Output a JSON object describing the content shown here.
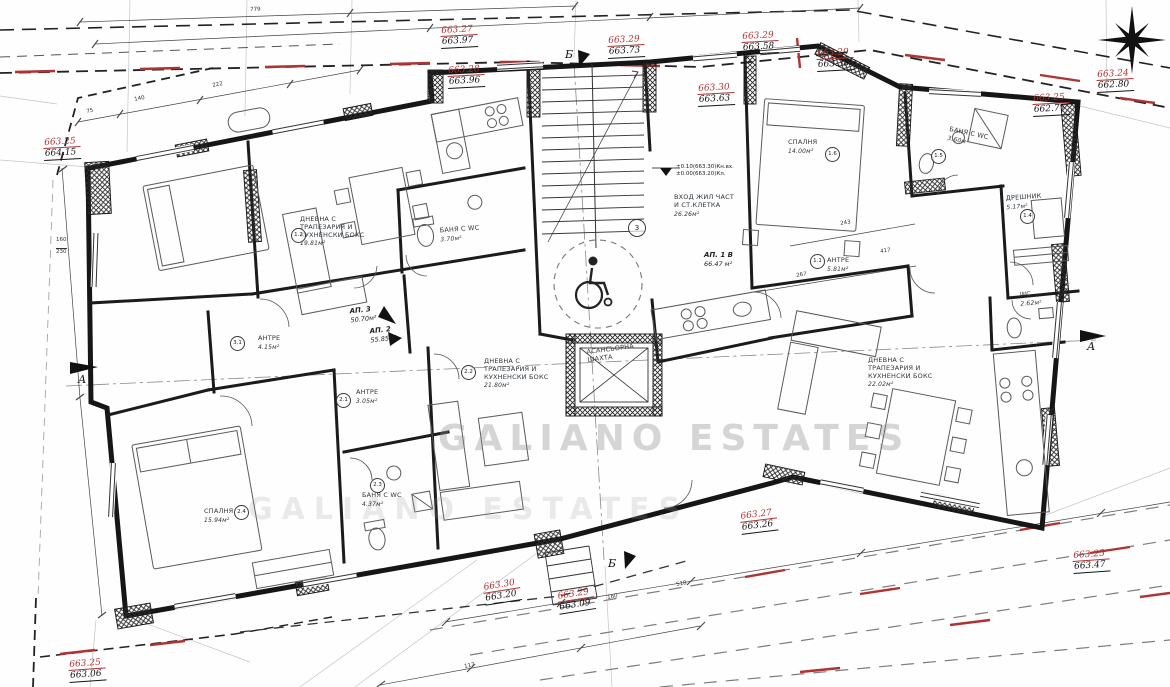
{
  "watermark": {
    "line1": "GALIANO ESTATES",
    "line2": "GALIANO ESTATES"
  },
  "colors": {
    "marker_red": "#b03232",
    "line_black": "#141414",
    "construction_gray": "#9a9a9a"
  },
  "icons": {
    "north": "north-arrow-icon",
    "wheelchair": "wheelchair-icon"
  },
  "axes": {
    "a": "А",
    "b": "Б"
  },
  "levels": {
    "line1": "±0.10(663.30)Кн.вх.",
    "line2": "±0.00(663.20)Кл."
  },
  "apartments": [
    {
      "label": "АП. 1 В",
      "area": "66.47 м²"
    },
    {
      "label": "АП. 2",
      "area": "55.85м²"
    },
    {
      "label": "АП. 3",
      "area": "50.70м²"
    }
  ],
  "rooms": [
    {
      "lines": [
        "ДНЕВНА С",
        "ТРАПЕЗАРИЯ И",
        "КУХНЕНСКИ БОКС"
      ],
      "area": "19.81м²"
    },
    {
      "lines": [
        "БАНЯ С WC"
      ],
      "area": "3.70м²"
    },
    {
      "lines": [
        "СПАЛНЯ"
      ],
      "area": "14.00м²"
    },
    {
      "lines": [
        "БАНЯ С WC"
      ],
      "area": "3.60м²"
    },
    {
      "lines": [
        "ДРЕШНИК"
      ],
      "area": "5.17м²"
    },
    {
      "lines": [
        "АНТРЕ"
      ],
      "area": "5.81м²"
    },
    {
      "lines": [
        "WC"
      ],
      "area": "2.62м²"
    },
    {
      "lines": [
        "ВХОД ЖИЛ ЧАСТ",
        "И СТ.КЛЕТКА"
      ],
      "area": "26.26м²"
    },
    {
      "lines": [
        "АНТРЕ"
      ],
      "area": "4.15м²"
    },
    {
      "lines": [
        "АНТРЕ"
      ],
      "area": "3.05м²"
    },
    {
      "lines": [
        "ДНЕВНА С",
        "ТРАПЕЗАРИЯ И",
        "КУХНЕНСКИ БОКС"
      ],
      "area": "21.80м²"
    },
    {
      "lines": [
        "АСАНСЬОРНА",
        "ШАХТА"
      ],
      "area": ""
    },
    {
      "lines": [
        "СПАЛНЯ"
      ],
      "area": "15.94м²"
    },
    {
      "lines": [
        "БАНЯ С WC"
      ],
      "area": "4.37м²"
    },
    {
      "lines": [
        "ДНЕВНА С",
        "ТРАПЕЗАРИЯ И",
        "КУХНЕНСКИ БОКС"
      ],
      "area": "22.02м²"
    }
  ],
  "circles": [
    "3",
    "1.2",
    "1.6",
    "1.5",
    "1.4",
    "1.1",
    "2.2",
    "2.1",
    "2.3",
    "2.4",
    "3.1"
  ],
  "elevations": [
    {
      "red": "663.27",
      "black": "663.97"
    },
    {
      "red": "663.28",
      "black": "663.96"
    },
    {
      "red": "663.29",
      "black": "663.73"
    },
    {
      "red": "663.29",
      "black": "663.58"
    },
    {
      "red": "663.29",
      "black": "663.38"
    },
    {
      "red": "663.30",
      "black": "663.63"
    },
    {
      "red": "663.24",
      "black": "662.80"
    },
    {
      "red": "663.25",
      "black": "662.77"
    },
    {
      "red": "663.25",
      "black": "664.15"
    },
    {
      "red": "663.30",
      "black": "663.20"
    },
    {
      "red": "663.29",
      "black": "663.09"
    },
    {
      "red": "663.27",
      "black": "663.26"
    },
    {
      "red": "663.25",
      "black": "663.47"
    },
    {
      "red": "663.25",
      "black": "663.06"
    }
  ],
  "dims": [
    "779",
    "222",
    "140",
    "75",
    "160",
    "230",
    "518",
    "160",
    "117",
    "243",
    "417",
    "267"
  ]
}
